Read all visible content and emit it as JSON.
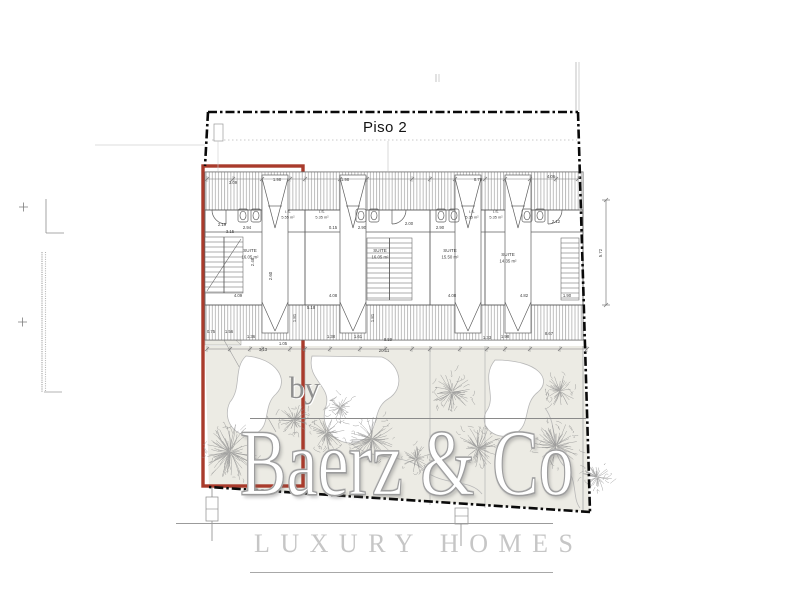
{
  "title": "Piso 2",
  "watermark": {
    "by": "by",
    "brand": "Baerz & Co",
    "tagline": "LUXURY HOMES"
  },
  "colors": {
    "red": "#A93B2C",
    "boundary": "#0A0A0A",
    "garden": "#ECEBE4",
    "tree": "#8E8E8E",
    "watermark_gray": "#C6C6C6",
    "plan_line": "#5F5F5F"
  },
  "plan": {
    "units": [
      {
        "x": 205,
        "w": 100,
        "col_x": 262,
        "bath_x": 238,
        "door_x": 226,
        "door_dir": -1,
        "suite_label": "SUITE",
        "suite_area": "16.05 m²",
        "suite_x": 250,
        "suite_y": 252,
        "is_label": "I.S.",
        "is_area": "5.55 m²",
        "is_x": 288,
        "is_y": 213
      },
      {
        "x": 305,
        "w": 125,
        "col_x": 340,
        "bath_x": 356,
        "door_x": 392,
        "door_dir": 1,
        "suite_label": "SUITE",
        "suite_area": "16.05 m²",
        "suite_x": 380,
        "suite_y": 252,
        "is_label": "I.S.",
        "is_area": "5.35 m²",
        "is_x": 322,
        "is_y": 213
      },
      {
        "x": 430,
        "w": 55,
        "col_x": 455,
        "bath_x": 436,
        "door_x": 0,
        "door_dir": -1,
        "suite_label": "SUITE",
        "suite_area": "15.50 m²",
        "suite_x": 450,
        "suite_y": 252,
        "is_label": "I.S.",
        "is_area": "5.35 m²",
        "is_x": 472,
        "is_y": 213
      },
      {
        "x": 485,
        "w": 98,
        "col_x": 505,
        "bath_x": 522,
        "door_x": 548,
        "door_dir": 1,
        "suite_label": "SUITE",
        "suite_area": "14.35 m²",
        "suite_x": 508,
        "suite_y": 256,
        "is_label": "I.S.",
        "is_area": "5.35 m²",
        "is_x": 496,
        "is_y": 213
      }
    ],
    "walls": [
      305,
      430,
      485
    ],
    "stairs": [
      {
        "x": 205,
        "y": 237,
        "w": 38,
        "h": 56,
        "divider": true,
        "diagonal": true
      },
      {
        "x": 367,
        "y": 238,
        "w": 45,
        "h": 62,
        "divider": true
      },
      {
        "x": 561,
        "y": 238,
        "w": 18,
        "h": 62
      }
    ],
    "dims": [
      {
        "t": "3.09",
        "x": 233,
        "y": 184
      },
      {
        "t": "1.98",
        "x": 277,
        "y": 181
      },
      {
        "t": "1.98",
        "x": 345,
        "y": 181
      },
      {
        "t": "8.79",
        "x": 478,
        "y": 181
      },
      {
        "t": "4.06",
        "x": 551,
        "y": 178
      },
      {
        "t": "2.19",
        "x": 222,
        "y": 226
      },
      {
        "t": "2.94",
        "x": 247,
        "y": 229
      },
      {
        "t": "2.90",
        "x": 362,
        "y": 229
      },
      {
        "t": "2.90",
        "x": 440,
        "y": 229
      },
      {
        "t": "2.00",
        "x": 409,
        "y": 225
      },
      {
        "t": "2.12",
        "x": 556,
        "y": 223
      },
      {
        "t": "3.15",
        "x": 230,
        "y": 233
      },
      {
        "t": "0.15",
        "x": 333,
        "y": 229
      },
      {
        "t": "5.18",
        "x": 311,
        "y": 309
      },
      {
        "t": "4.09",
        "x": 238,
        "y": 297
      },
      {
        "t": "4.08",
        "x": 333,
        "y": 297
      },
      {
        "t": "4.08",
        "x": 452,
        "y": 297
      },
      {
        "t": "4.82",
        "x": 524,
        "y": 297
      },
      {
        "t": "1.90",
        "x": 567,
        "y": 297
      },
      {
        "t": "2.60",
        "x": 272,
        "y": 276,
        "r": -90
      },
      {
        "t": "2.48",
        "x": 254,
        "y": 262,
        "r": -90
      },
      {
        "t": "1.81",
        "x": 296,
        "y": 318,
        "r": -90
      },
      {
        "t": "1.81",
        "x": 374,
        "y": 318,
        "r": -90
      },
      {
        "t": "0.75",
        "x": 211,
        "y": 333
      },
      {
        "t": "1.56",
        "x": 229,
        "y": 333
      },
      {
        "t": "1.36",
        "x": 251,
        "y": 338
      },
      {
        "t": "1.05",
        "x": 283,
        "y": 345
      },
      {
        "t": "3.13",
        "x": 263,
        "y": 351
      },
      {
        "t": "1.38",
        "x": 331,
        "y": 338
      },
      {
        "t": "1.61",
        "x": 358,
        "y": 338
      },
      {
        "t": "1.33",
        "x": 487,
        "y": 339
      },
      {
        "t": "1.98",
        "x": 505,
        "y": 338
      },
      {
        "t": "8.67",
        "x": 549,
        "y": 335
      },
      {
        "t": "8.59",
        "x": 388,
        "y": 341
      },
      {
        "t": "20.11",
        "x": 384,
        "y": 352
      },
      {
        "t": "5.72",
        "x": 602,
        "y": 253,
        "r": -90
      }
    ],
    "tickrows": [
      {
        "y": 179,
        "x1": 207,
        "x2": 578,
        "ticks": [
          207,
          233,
          262,
          290,
          305,
          340,
          367,
          412,
          430,
          455,
          485,
          505,
          530,
          556,
          578
        ]
      },
      {
        "y": 349,
        "x1": 207,
        "x2": 587,
        "ticks": [
          207,
          230,
          250,
          262,
          290,
          305,
          330,
          360,
          385,
          412,
          430,
          460,
          487,
          505,
          530,
          560,
          587
        ]
      }
    ],
    "vdim": {
      "x": 606,
      "y1": 200,
      "y2": 305
    },
    "trees": [
      [
        230,
        452,
        30
      ],
      [
        294,
        420,
        17
      ],
      [
        326,
        433,
        20
      ],
      [
        372,
        439,
        24
      ],
      [
        416,
        459,
        15
      ],
      [
        340,
        407,
        13
      ],
      [
        452,
        392,
        21
      ],
      [
        478,
        448,
        22
      ],
      [
        556,
        446,
        24
      ],
      [
        560,
        391,
        16
      ],
      [
        597,
        477,
        15
      ]
    ]
  }
}
